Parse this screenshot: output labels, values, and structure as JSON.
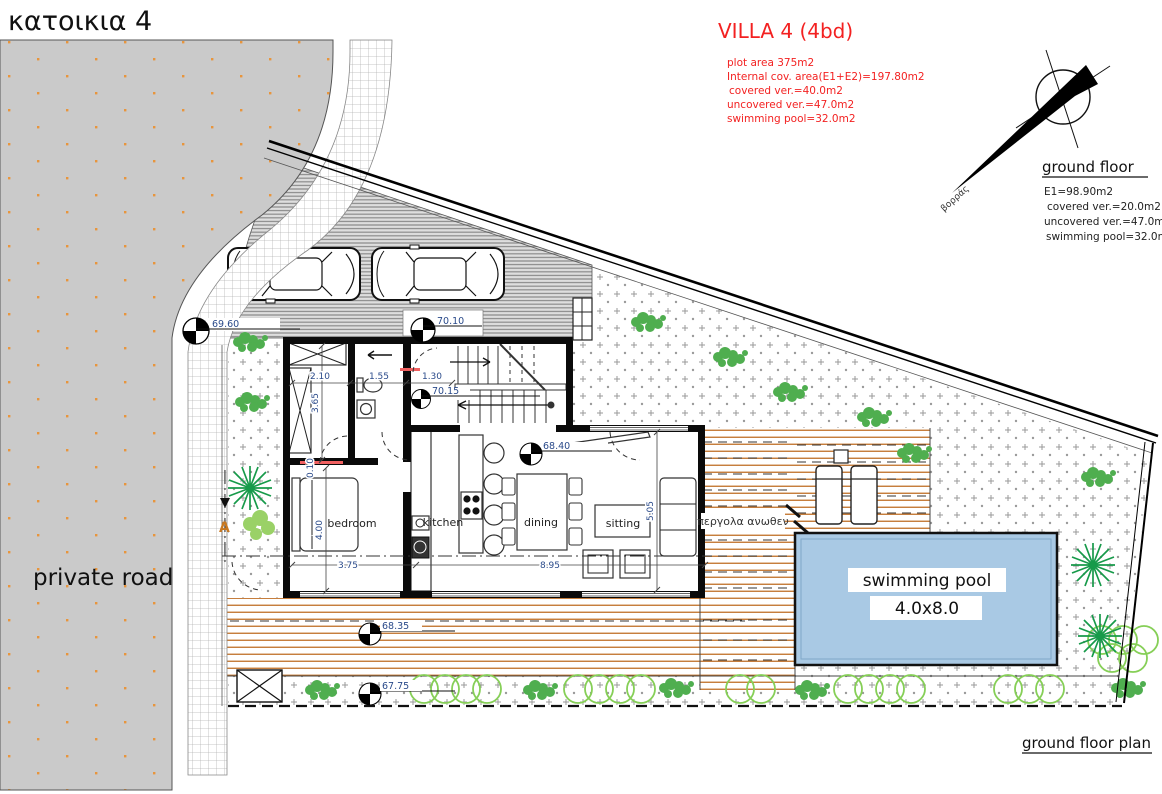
{
  "title": "κατοικια 4",
  "villa_info": {
    "header": "VILLA 4 (4bd)",
    "lines": [
      "plot area 375m2",
      "Internal cov. area(E1+E2)=197.80m2",
      "covered ver.=40.0m2",
      "uncovered ver.=47.0m2",
      "swimming pool=32.0m2"
    ]
  },
  "ground_floor_info": {
    "header": "ground floor",
    "lines": [
      "E1=98.90m2",
      "covered ver.=20.0m2",
      "uncovered ver.=47.0m2",
      "swimming pool=32.0m2"
    ]
  },
  "compass": {
    "label": "βορράς"
  },
  "labels": {
    "private_road": "private road",
    "footer": "ground floor plan",
    "pergola": "περγολα ανωθεν",
    "section": "A"
  },
  "rooms": {
    "bedroom": "bedroom",
    "kitchen": "kitchen",
    "dining": "dining",
    "sitting": "sitting"
  },
  "pool": {
    "line1": "swimming pool",
    "line2": "4.0x8.0"
  },
  "dims": {
    "w1": "2.10",
    "w2": "1.55",
    "w3": "1.30",
    "h1": "3.65",
    "h2": "0.10",
    "h3": "4.00",
    "b1": "3.75",
    "b2": "8.95",
    "s1": "5.05"
  },
  "levels": {
    "road": "69.60",
    "drive": "70.10",
    "entry": "70.15",
    "living": "68.40",
    "deck": "68.35",
    "garden": "67.75"
  },
  "colors": {
    "annotation_red": "#f32121",
    "pool_fill": "#a9c9e4",
    "deck_line": "#c07028",
    "road_fill": "#cacaca",
    "plant_green": "#4fae4f",
    "hedge_green": "#86cf57",
    "dim_text": "#2a4a8a"
  }
}
